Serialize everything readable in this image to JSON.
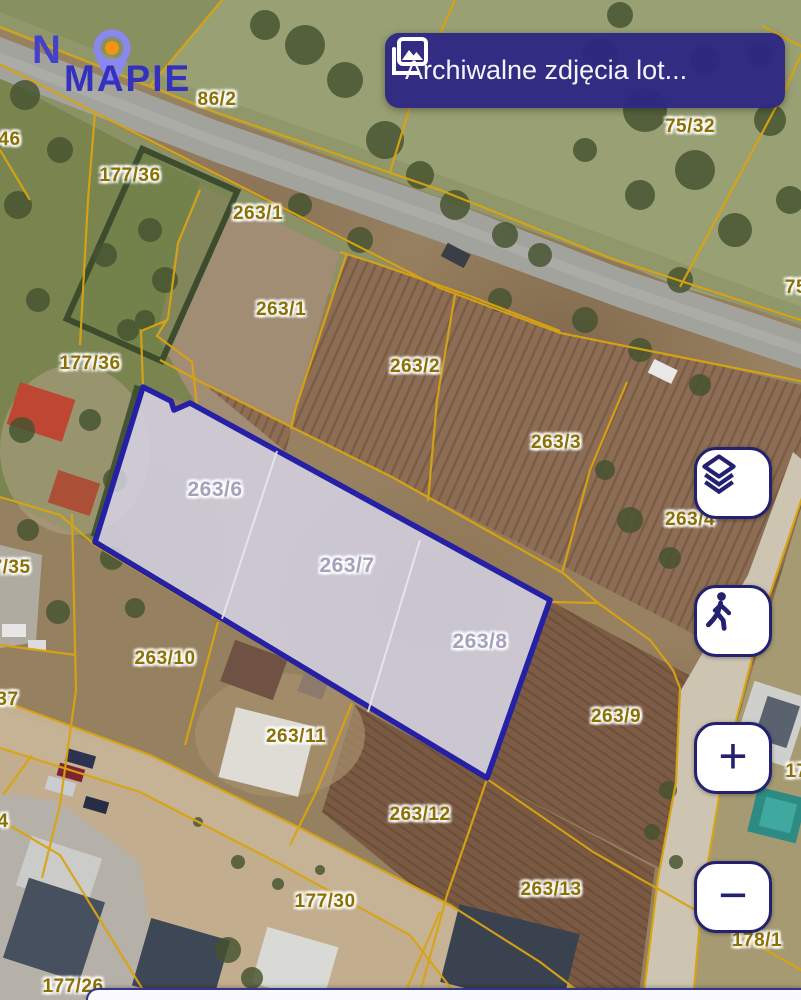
{
  "logo": {
    "word1": "N",
    "word2": "MAPIE"
  },
  "top_button": {
    "label": "Archiwalne zdjęcia lot..."
  },
  "controls": {
    "zoom_in": "+",
    "zoom_out": "−"
  },
  "colors": {
    "accent_navy": "#232170",
    "parcel_line_yellow": "#d9a411",
    "selected_parcel_stroke": "#2520a4",
    "selected_parcel_fill": "rgba(213,211,229,0.85)",
    "label_olive": "#8a7005",
    "label_selected_gray": "#a3a1bb",
    "button_bg": "#2c2783"
  },
  "selected_parcels": [
    "263/6",
    "263/7",
    "263/8"
  ],
  "labels": [
    {
      "text": "86/2"
    },
    {
      "text": "75/32"
    },
    {
      "text": "177/46"
    },
    {
      "text": "177/36"
    },
    {
      "text": "263/1"
    },
    {
      "text": "263/1"
    },
    {
      "text": "75"
    },
    {
      "text": "263/2"
    },
    {
      "text": "177/36"
    },
    {
      "text": "263/3"
    },
    {
      "text": "263/4"
    },
    {
      "text": "177/35"
    },
    {
      "text": "263/6"
    },
    {
      "text": "263/7"
    },
    {
      "text": "263/8"
    },
    {
      "text": "263/10"
    },
    {
      "text": "177/37"
    },
    {
      "text": "263/11"
    },
    {
      "text": "263/9"
    },
    {
      "text": "263/12"
    },
    {
      "text": "177/34"
    },
    {
      "text": "177"
    },
    {
      "text": "177/30"
    },
    {
      "text": "263/13"
    },
    {
      "text": "178/1"
    },
    {
      "text": "177/26"
    }
  ]
}
